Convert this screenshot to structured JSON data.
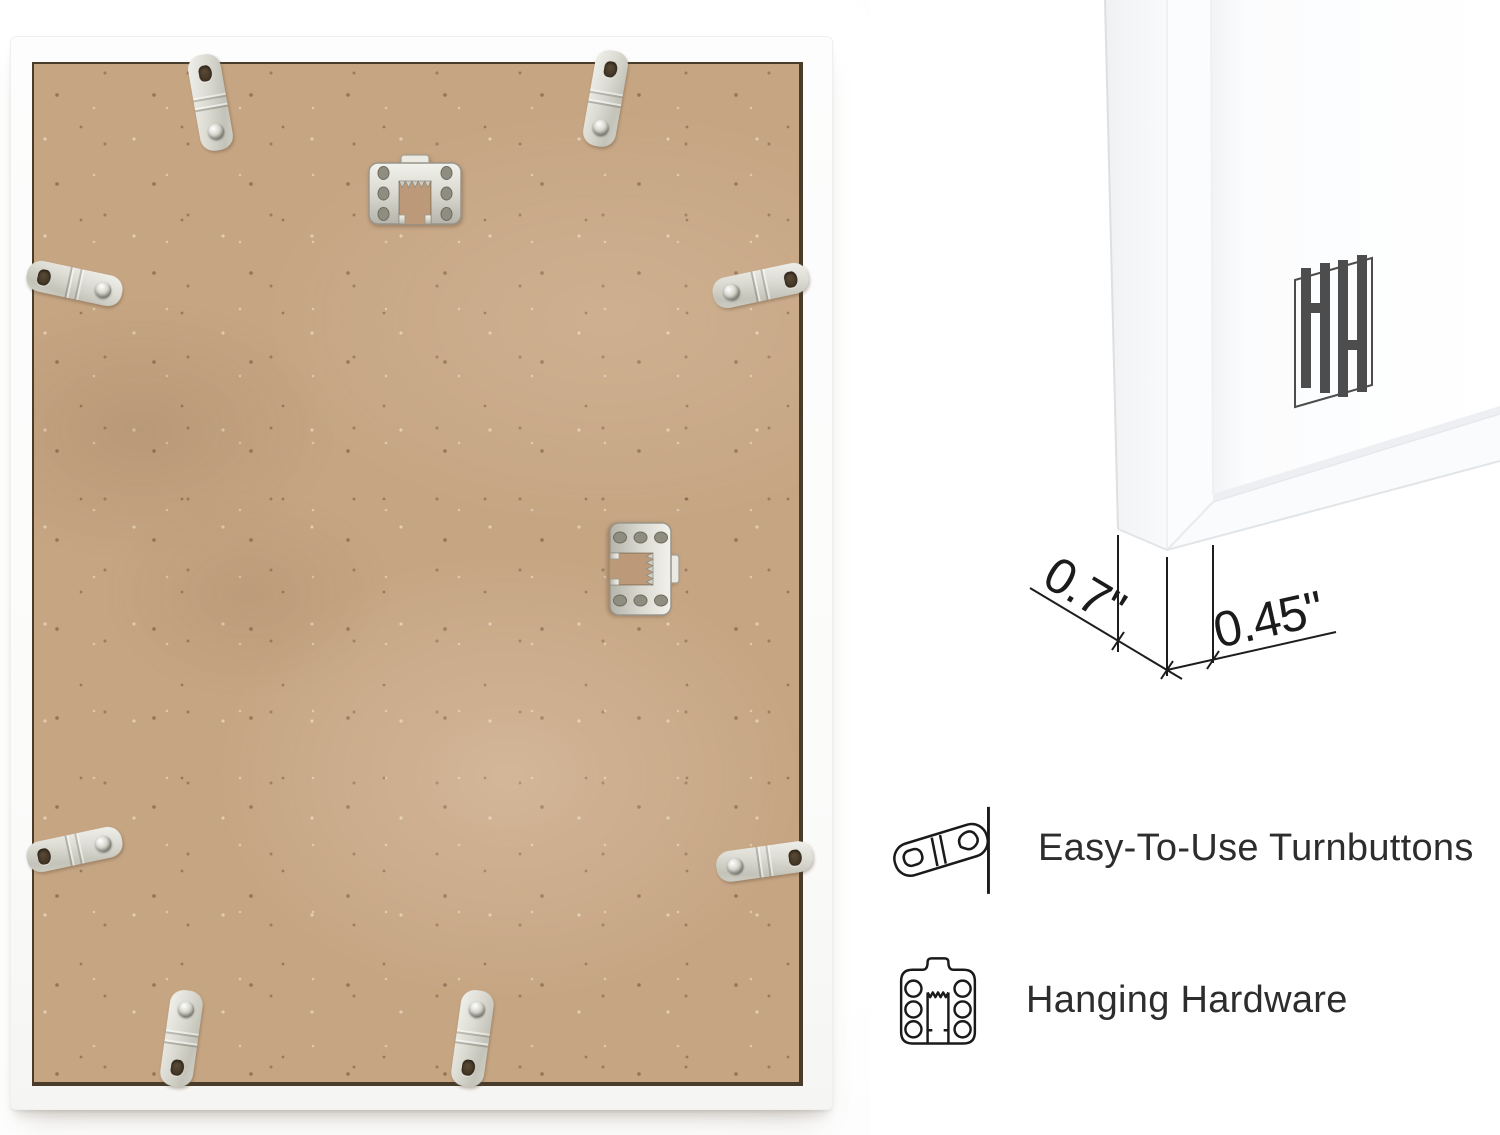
{
  "image": {
    "width": 1500,
    "height": 1135,
    "background": "#ffffff"
  },
  "frame_back_photo": {
    "frame_color": "#fcfcfb",
    "backing_board_color": "#c6a583",
    "hardware_metal_color": "#d6d6cd",
    "turnbutton_count": 8,
    "sawtooth_hanger_count": 2
  },
  "corner_detail": {
    "depth_label": "0.7\"",
    "face_label": "0.45\"",
    "logo_icon": "hh-monogram",
    "logo_color": "#4d4d4d"
  },
  "features": [
    {
      "icon": "turnbutton-icon",
      "label": "Easy-To-Use Turnbuttons"
    },
    {
      "icon": "hanging-hardware-icon",
      "label": "Hanging Hardware"
    }
  ],
  "colors": {
    "text": "#2d2d2d",
    "line_art": "#1a1a1a",
    "dimension": "#1b1b1b"
  }
}
